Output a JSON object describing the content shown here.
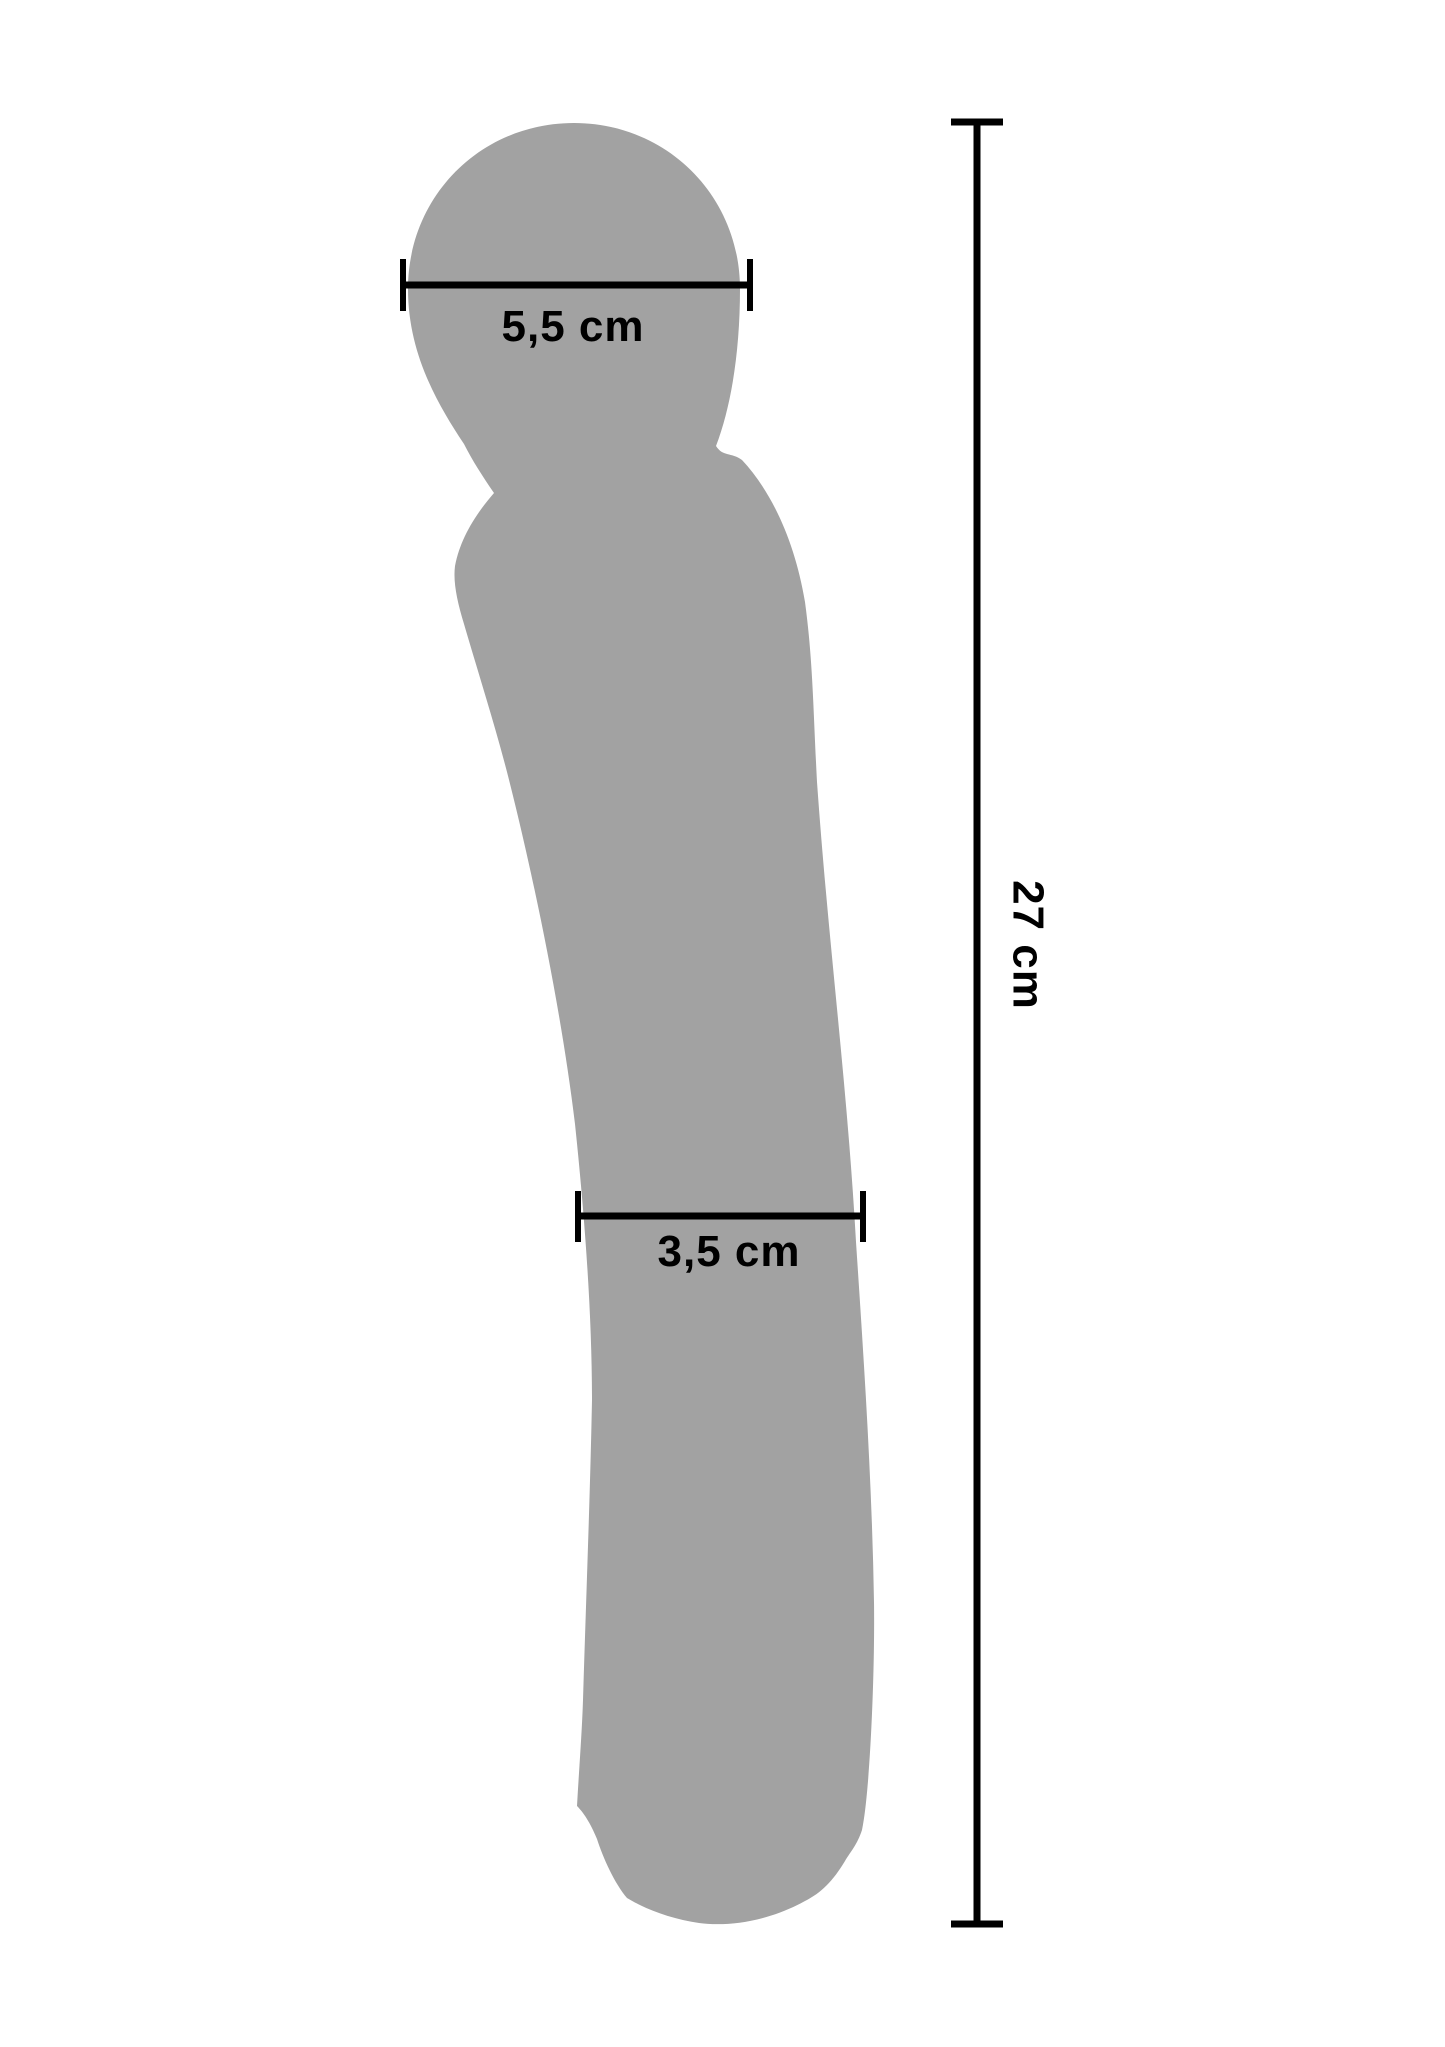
{
  "page": {
    "background": "#ffffff"
  },
  "colors": {
    "silhouette": "#a2a2a2",
    "dimension_lines": "#000000",
    "label_text": "#000000"
  },
  "measurements": {
    "head_diameter": {
      "label": "5,5 cm"
    },
    "shaft_diameter": {
      "label": "3,5 cm"
    },
    "total_length": {
      "label": "27 cm"
    }
  }
}
